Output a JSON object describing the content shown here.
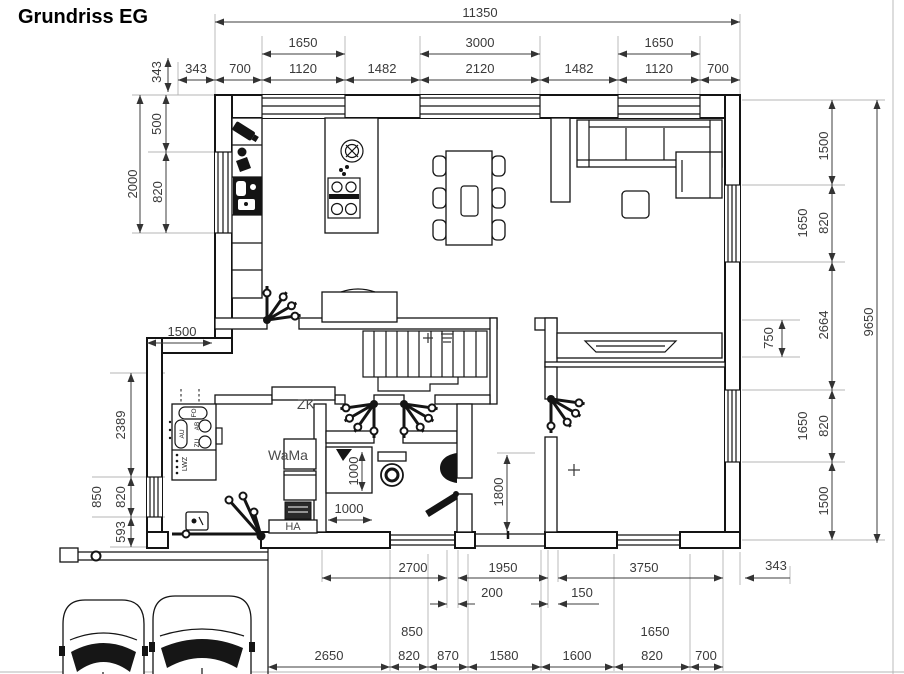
{
  "title": "Grundriss EG",
  "colors": {
    "line": "#141414",
    "dim_text": "#3a3a3a",
    "extension": "#b4b4b4"
  },
  "plan_labels": {
    "zk": "ZK",
    "wama": "WaMa",
    "ha": "HA",
    "lwz": "LWZ",
    "ab": "AB",
    "zu": "ZU",
    "au": "AU",
    "fo": "FO"
  },
  "dims": {
    "top": {
      "overall": "11350",
      "row2": [
        "1650",
        "3000",
        "1650"
      ],
      "row3": [
        "343",
        "700",
        "1120",
        "1482",
        "2120",
        "1482",
        "1120",
        "700"
      ]
    },
    "left": {
      "offset": "343",
      "d500": "500",
      "d2000": "2000",
      "d820_window": "820",
      "d1500_wing": "1500",
      "d2389": "2389",
      "d850": "850",
      "d820_lower": "820",
      "d593": "593"
    },
    "right": {
      "overall": "9650",
      "d1500_top": "1500",
      "d1650_top": "1650",
      "d820_top": "820",
      "d2664": "2664",
      "d750": "750",
      "d1650_low": "1650",
      "d820_low": "820",
      "d1500_low": "1500",
      "d343": "343"
    },
    "bottom": {
      "row1": [
        "2700",
        "1950",
        "3750"
      ],
      "row2": [
        "200",
        "150"
      ],
      "d850_over": "850",
      "d1650_over": "1650",
      "row3": [
        "2650",
        "820",
        "870",
        "1580",
        "1600",
        "820",
        "700"
      ]
    },
    "interior": {
      "v1000": "1000",
      "h1000": "1000",
      "d1800": "1800"
    }
  }
}
